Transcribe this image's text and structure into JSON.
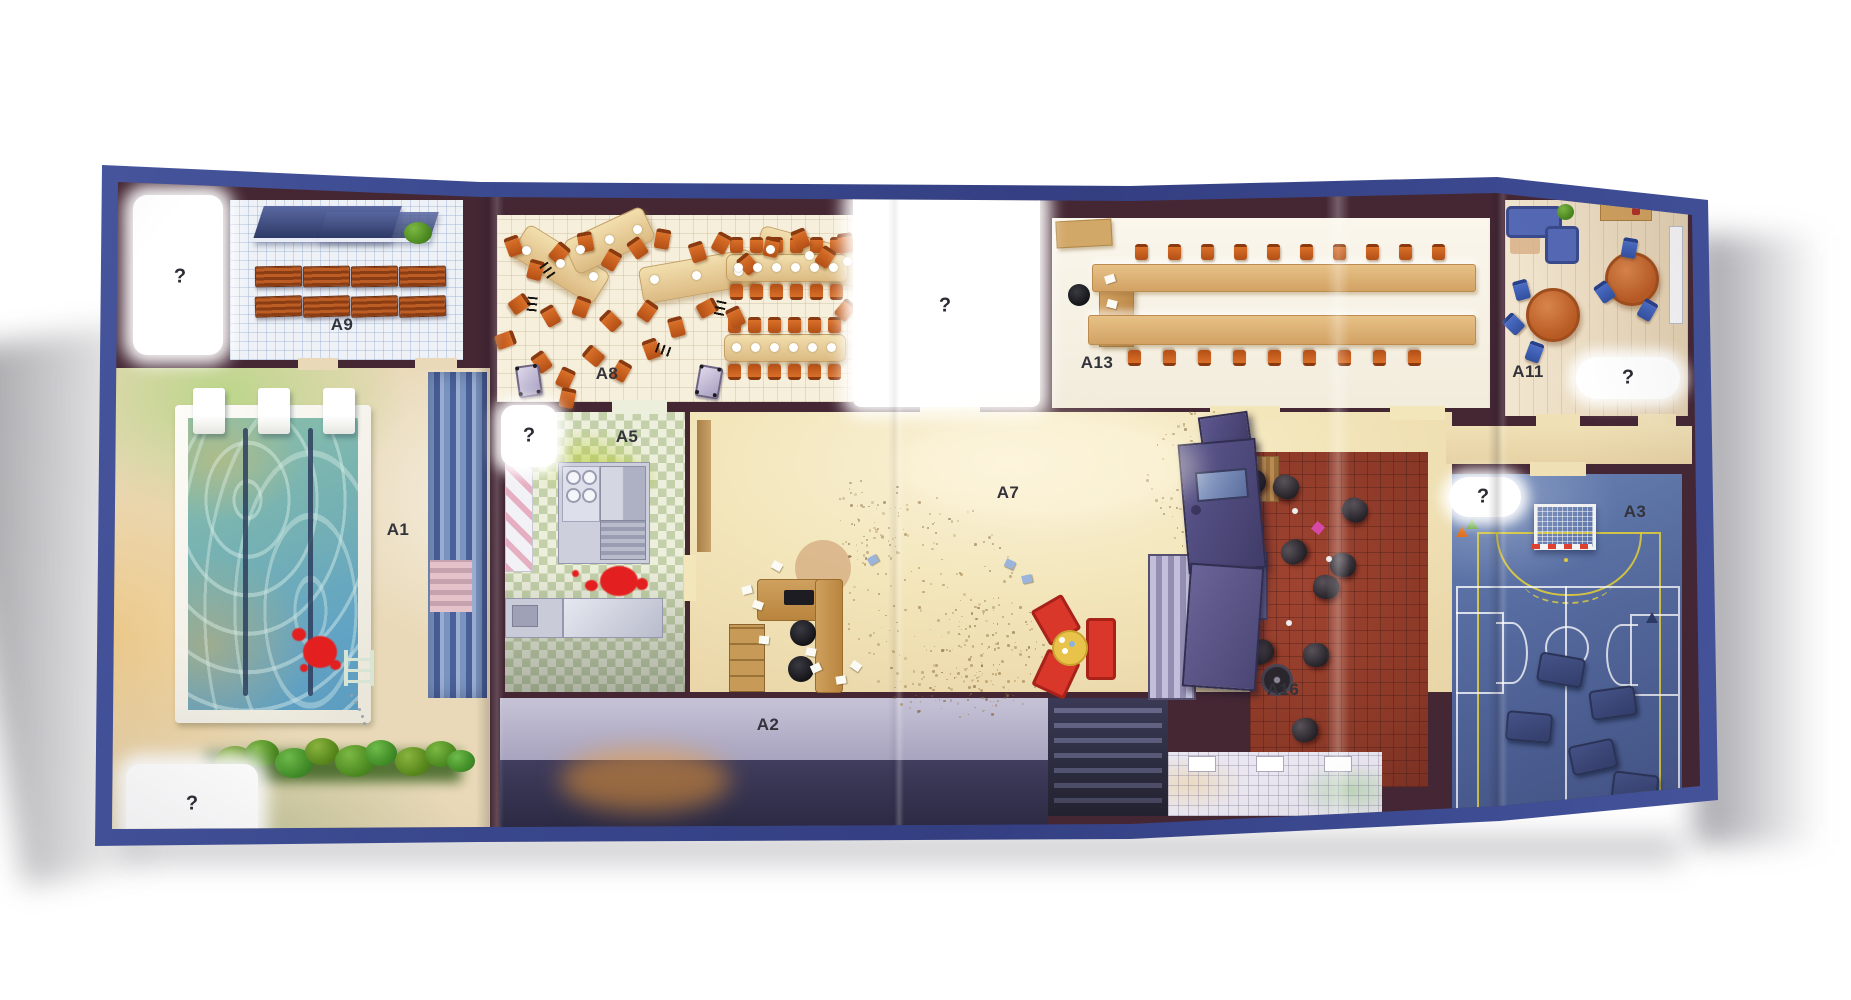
{
  "qmark": "?",
  "rooms": [
    {
      "id": "A9",
      "type": "locker-room"
    },
    {
      "id": "A1",
      "type": "swimming-pool"
    },
    {
      "id": "A8",
      "type": "cafeteria"
    },
    {
      "id": "A5",
      "type": "kitchen"
    },
    {
      "id": "A7",
      "type": "entrance-hall"
    },
    {
      "id": "A2",
      "type": "corridor"
    },
    {
      "id": "A13",
      "type": "classroom"
    },
    {
      "id": "A11",
      "type": "reading-room"
    },
    {
      "id": "A16",
      "type": "common-room"
    },
    {
      "id": "A3",
      "type": "gymnasium"
    }
  ],
  "unknown_markers": {
    "symbol": "?",
    "count": 6
  },
  "colors": {
    "board_frame": "#3f4e96",
    "wall": "#452734",
    "pool_water": "#6fae9c",
    "deck": "#e9d9b8",
    "cafeteria_floor": "#f6efdc",
    "chair_orange": "#c2591d",
    "kitchen_checker": "#c3d0a9",
    "hall_floor": "#f3e6bb",
    "corridor": "#b7b3c9",
    "classroom_desk": "#dcae72",
    "lounge_floor": "#943d2b",
    "gym_floor": "#5872a8",
    "court_line_yellow": "#decd3c",
    "blood_red": "#e41f1f",
    "round_table": "#c06030",
    "stage_purple": "#565085"
  }
}
